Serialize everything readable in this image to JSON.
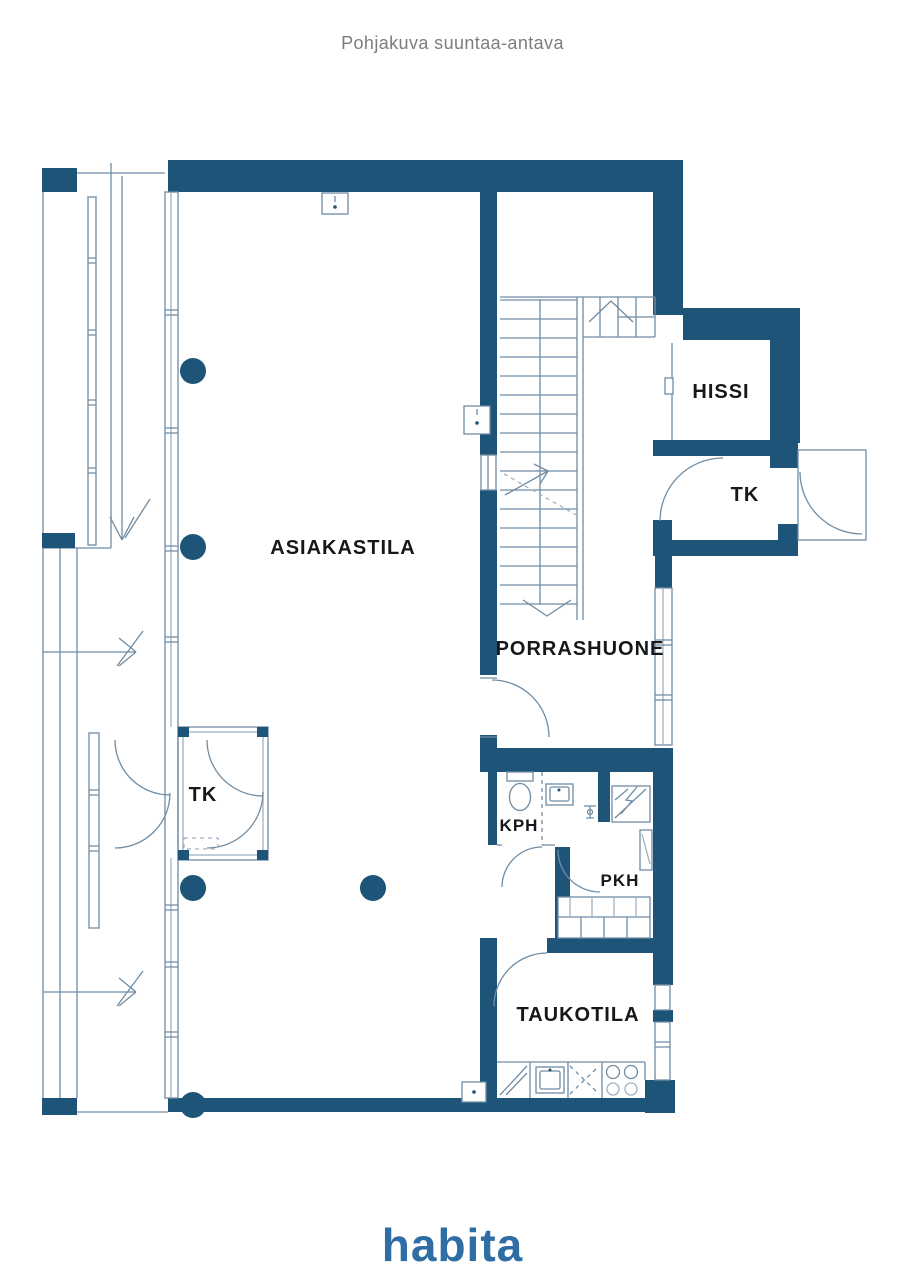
{
  "page": {
    "title": "Pohjakuva suuntaa-antava",
    "brand": "habita"
  },
  "palette": {
    "background": "#ffffff",
    "wall": "#1d5478",
    "line": "#6f8ca3",
    "line_light": "#9db2c4",
    "label": "#15171a",
    "title": "#7d7d7d",
    "brand": "#2f6ea5"
  },
  "rooms": {
    "asiakastila": {
      "label": "ASIAKASTILA"
    },
    "porrashuone": {
      "label": "PORRASHUONE"
    },
    "hissi": {
      "label": "HISSI"
    },
    "tk_entry": {
      "label": "TK"
    },
    "tk_vestibule": {
      "label": "TK"
    },
    "kph": {
      "label": "KPH"
    },
    "pkh": {
      "label": "PKH"
    },
    "taukotila": {
      "label": "TAUKOTILA"
    }
  },
  "symbols": {
    "stairs": "stair-treads-with-direction-arrows",
    "door_swing": "quarter-circle-arc",
    "column": "filled-circle",
    "window": "double-line-with-mullions",
    "toilet": "tank-and-bowl",
    "sink": "basin-rect",
    "stove": "four-burner-circles",
    "fridge": "diagonal-slash-unit",
    "dishwasher": "dashed-cross-unit",
    "electrical_panel": "hatched-square-with-arrow",
    "shelving": "divided-rect",
    "entrance_arrow": "arrow",
    "wall_box": "small-wall-cabinet"
  }
}
